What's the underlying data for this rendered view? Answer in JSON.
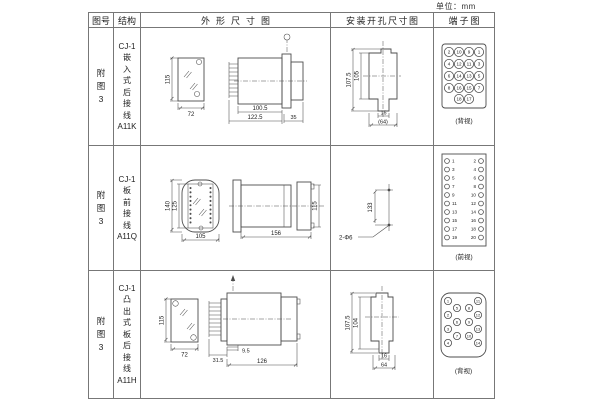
{
  "page": {
    "unit_label": "单位：mm"
  },
  "headers": {
    "figure": "图号",
    "structure": "结构",
    "outline": "外形尺寸图",
    "mounting": "安装开孔尺寸图",
    "terminal": "端子图"
  },
  "rows": [
    {
      "figure_no": "附\n图\n3",
      "structure": "CJ-1\n嵌\n入\n式\n后\n接\n线\nA11K",
      "outline": {
        "height": "115",
        "width": "72",
        "len_body": "100.5",
        "len_total": "122.5",
        "len_flange": "35"
      },
      "mounting": {
        "dim_outer": "107.5",
        "dim_inner": "105",
        "dim_slot": "16",
        "dim_span": "(64)"
      },
      "terminal": {
        "view": "(背视)",
        "numbers": [
          "2",
          "10",
          "9",
          "1",
          "4",
          "12",
          "11",
          "3",
          "6",
          "14",
          "13",
          "5",
          "8",
          "16",
          "15",
          "7",
          "18",
          "17"
        ]
      }
    },
    {
      "figure_no": "附\n图\n3",
      "structure": "CJ-1\n板\n前\n接\n线\nA11Q",
      "outline": {
        "height_outer": "140",
        "height_inner": "125",
        "width": "105",
        "len_body": "156",
        "side_height": "115"
      },
      "mounting": {
        "dim_span": "133",
        "hole_label": "2-Φ6"
      },
      "terminal": {
        "view": "(前视)",
        "left": [
          "1",
          "3",
          "5",
          "7",
          "9",
          "11",
          "13",
          "15",
          "17",
          "19"
        ],
        "right": [
          "2",
          "4",
          "6",
          "8",
          "10",
          "12",
          "14",
          "16",
          "18",
          "20"
        ]
      }
    },
    {
      "figure_no": "附\n图\n3",
      "structure": "CJ-1\n凸\n出\n式\n板\n后\n接\n线\nA11H",
      "outline": {
        "height": "115",
        "width": "72",
        "len_pins": "31.5",
        "len_offset": "9.5",
        "len_body": "126"
      },
      "mounting": {
        "dim_outer": "107.5",
        "dim_inner": "104",
        "dim_slot": "16",
        "dim_span": "64"
      },
      "terminal": {
        "view": "(背视)",
        "numbers": [
          "1",
          "2",
          "3",
          "4",
          "5",
          "6",
          "7",
          "8",
          "9",
          "10",
          "11",
          "12",
          "13",
          "14"
        ]
      }
    }
  ]
}
